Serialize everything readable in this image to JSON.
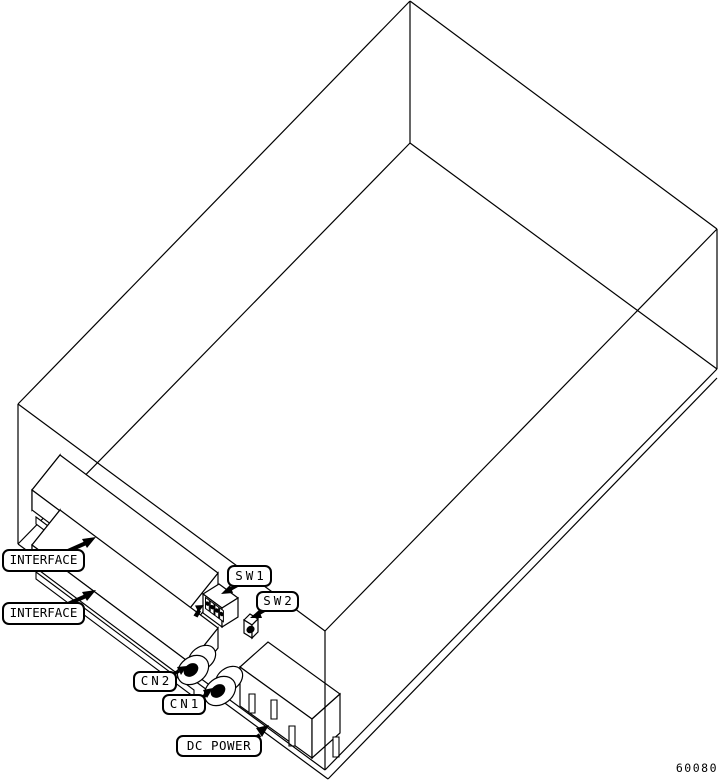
{
  "figure": {
    "drawing_number": "60080",
    "description": "Isometric outline drawing of drive enclosure showing rear connectors"
  },
  "colors": {
    "line": "#000000",
    "background": "#ffffff"
  },
  "labels": {
    "interface1": {
      "text": "INTERFACE",
      "x": 2,
      "y": 549,
      "w": 83,
      "h": 23
    },
    "interface2": {
      "text": "INTERFACE",
      "x": 2,
      "y": 602,
      "w": 83,
      "h": 23
    },
    "sw1": {
      "text": "SW1",
      "x": 227,
      "y": 565,
      "w": 45,
      "h": 22
    },
    "sw2": {
      "text": "SW2",
      "x": 256,
      "y": 591,
      "w": 43,
      "h": 21
    },
    "cn2": {
      "text": "CN2",
      "x": 133,
      "y": 671,
      "w": 44,
      "h": 21
    },
    "cn1": {
      "text": "CN1",
      "x": 162,
      "y": 694,
      "w": 44,
      "h": 21
    },
    "dc_power": {
      "text": "DC POWER",
      "x": 176,
      "y": 735,
      "w": 86,
      "h": 22
    },
    "drawing_number": {
      "text": "60080",
      "x": 672,
      "y": 760,
      "w": 46,
      "h": 16
    }
  },
  "drawing": {
    "width": 718,
    "height": 783,
    "elements": [
      {
        "n": "enclosure-top-back-left-edge",
        "t": "line",
        "p": [
          410,
          1,
          18,
          404
        ],
        "w": 1.2
      },
      {
        "n": "enclosure-top-back-right-edge",
        "t": "line",
        "p": [
          410,
          1,
          717,
          229
        ],
        "w": 1.2
      },
      {
        "n": "enclosure-back-vertical-edge",
        "t": "line",
        "p": [
          410,
          1,
          410,
          143
        ],
        "w": 1.2
      },
      {
        "n": "enclosure-bottom-back-left-edge",
        "t": "line",
        "p": [
          410,
          143,
          18,
          544
        ],
        "w": 1.2
      },
      {
        "n": "enclosure-bottom-back-right-edge",
        "t": "line",
        "p": [
          410,
          143,
          717,
          369
        ],
        "w": 1.2
      },
      {
        "n": "enclosure-left-vertical-edge",
        "t": "line",
        "p": [
          18,
          404,
          18,
          544
        ],
        "w": 1.2
      },
      {
        "n": "enclosure-top-front-left-edge",
        "t": "line",
        "p": [
          18,
          404,
          325,
          631
        ],
        "w": 1.2
      },
      {
        "n": "enclosure-top-front-right-edge",
        "t": "line",
        "p": [
          717,
          229,
          325,
          631
        ],
        "w": 1.2
      },
      {
        "n": "enclosure-right-vertical-edge",
        "t": "line",
        "p": [
          717,
          229,
          717,
          369
        ],
        "w": 1.2
      },
      {
        "n": "dc-power-connector-top-face",
        "t": "poly",
        "p": [
          240,
          667,
          268,
          642,
          340,
          694,
          312,
          719
        ],
        "f": "#fff",
        "w": 1.2
      },
      {
        "n": "dc-power-connector-front-face",
        "t": "poly",
        "p": [
          240,
          667,
          312,
          719,
          312,
          758,
          240,
          706
        ],
        "f": "#fff",
        "w": 1.2
      },
      {
        "n": "dc-power-connector-right-face",
        "t": "poly",
        "p": [
          312,
          719,
          340,
          694,
          340,
          733,
          312,
          758
        ],
        "f": "#fff",
        "w": 1.2
      },
      {
        "n": "dc-power-pin-slot-1",
        "t": "poly",
        "p": [
          249,
          694,
          255,
          694,
          255,
          713,
          249,
          713
        ],
        "f": "#fff",
        "w": 1.1
      },
      {
        "n": "dc-power-pin-slot-2",
        "t": "poly",
        "p": [
          271,
          700,
          277,
          700,
          277,
          719,
          271,
          719
        ],
        "f": "#fff",
        "w": 1.1
      },
      {
        "n": "dc-power-pin-slot-3",
        "t": "poly",
        "p": [
          289,
          726,
          295,
          726,
          295,
          746,
          289,
          746
        ],
        "f": "#fff",
        "w": 1.1
      },
      {
        "n": "dc-power-pin-slot-4",
        "t": "poly",
        "p": [
          333,
          737,
          339,
          737,
          339,
          757,
          333,
          757
        ],
        "f": "#fff",
        "w": 1.1
      },
      {
        "n": "enclosure-bottom-front-left-edge",
        "t": "line",
        "p": [
          18,
          544,
          325,
          770
        ],
        "w": 1.2
      },
      {
        "n": "base-plate-left-edge",
        "t": "line",
        "p": [
          21,
          553,
          328,
          779
        ],
        "w": 1.2
      },
      {
        "n": "enclosure-front-vertical-edge",
        "t": "line",
        "p": [
          325,
          631,
          325,
          770
        ],
        "w": 1.2
      },
      {
        "n": "enclosure-bottom-front-right-edge",
        "t": "line",
        "p": [
          717,
          369,
          325,
          770
        ],
        "w": 1.2
      },
      {
        "n": "base-plate-right-edge",
        "t": "line",
        "p": [
          717,
          378,
          328,
          779
        ],
        "w": 1.2
      },
      {
        "n": "interface-connector1-left-end",
        "t": "poly",
        "p": [
          60,
          455,
          32,
          490,
          32,
          510,
          60,
          475
        ],
        "f": "#fff",
        "w": 1.2
      },
      {
        "n": "interface-connector1-right-end",
        "t": "poly",
        "p": [
          218,
          573,
          190,
          608,
          190,
          628,
          218,
          593
        ],
        "f": "#fff",
        "w": 1.2
      },
      {
        "n": "interface-connector1-top-face",
        "t": "poly",
        "p": [
          60,
          455,
          218,
          573,
          190,
          608,
          32,
          490
        ],
        "f": "#fff",
        "w": 1.2
      },
      {
        "n": "interface-connector1-front-face",
        "t": "poly",
        "p": [
          32,
          490,
          190,
          608,
          190,
          628,
          32,
          510
        ],
        "f": "#fff",
        "w": 1.2
      },
      {
        "n": "interface-card-edge-1",
        "t": "poly",
        "p": [
          36,
          517,
          194,
          635,
          194,
          642,
          36,
          524
        ],
        "f": "#fff",
        "w": 1.1
      },
      {
        "n": "interface-connector2-left-end",
        "t": "poly",
        "p": [
          60,
          510,
          32,
          545,
          32,
          565,
          60,
          530
        ],
        "f": "#fff",
        "w": 1.2
      },
      {
        "n": "interface-connector2-right-end",
        "t": "poly",
        "p": [
          218,
          628,
          190,
          663,
          190,
          683,
          218,
          648
        ],
        "f": "#fff",
        "w": 1.2
      },
      {
        "n": "interface-connector2-top-face",
        "t": "poly",
        "p": [
          60,
          510,
          218,
          628,
          190,
          663,
          32,
          545
        ],
        "f": "#fff",
        "w": 1.2
      },
      {
        "n": "interface-connector2-front-face",
        "t": "poly",
        "p": [
          32,
          545,
          190,
          663,
          190,
          683,
          32,
          565
        ],
        "f": "#fff",
        "w": 1.2
      },
      {
        "n": "interface-card-edge-2",
        "t": "poly",
        "p": [
          36,
          572,
          194,
          690,
          194,
          697,
          36,
          579
        ],
        "f": "#fff",
        "w": 1.1
      },
      {
        "n": "cn2-connector-barrel",
        "t": "ell",
        "c": [
          202,
          658
        ],
        "r": [
          15,
          11
        ],
        "rot": -38,
        "f": "#fff",
        "w": 1.2
      },
      {
        "n": "cn2-connector-flange",
        "t": "ell",
        "c": [
          193,
          670
        ],
        "r": [
          17,
          13
        ],
        "rot": -38,
        "f": "#fff",
        "w": 1.2
      },
      {
        "n": "cn2-connector-hole",
        "t": "ell",
        "c": [
          191,
          670
        ],
        "r": [
          8,
          6
        ],
        "rot": -38,
        "f": "#000",
        "w": 0
      },
      {
        "n": "cn1-connector-barrel",
        "t": "ell",
        "c": [
          229,
          679
        ],
        "r": [
          15,
          11
        ],
        "rot": -38,
        "f": "#fff",
        "w": 1.2
      },
      {
        "n": "cn1-connector-flange",
        "t": "ell",
        "c": [
          220,
          691
        ],
        "r": [
          17,
          13
        ],
        "rot": -38,
        "f": "#fff",
        "w": 1.2
      },
      {
        "n": "cn1-connector-hole",
        "t": "ell",
        "c": [
          218,
          691
        ],
        "r": [
          8,
          6
        ],
        "rot": -38,
        "f": "#000",
        "w": 0
      },
      {
        "n": "sw1-dip-switch-top-face",
        "t": "poly",
        "p": [
          203,
          594,
          219,
          584,
          238,
          598,
          222,
          608
        ],
        "f": "#fff",
        "w": 1.2
      },
      {
        "n": "sw1-dip-switch-front-face",
        "t": "poly",
        "p": [
          203,
          594,
          222,
          608,
          222,
          627,
          203,
          613
        ],
        "f": "#fff",
        "w": 1.2
      },
      {
        "n": "sw1-dip-switch-right-face",
        "t": "poly",
        "p": [
          222,
          608,
          238,
          598,
          238,
          617,
          222,
          627
        ],
        "f": "#fff",
        "w": 1.2
      },
      {
        "n": "sw1-dip-position-1",
        "t": "poly",
        "p": [
          205.5,
          597.5,
          209.3,
          600.3,
          209.3,
          611.3,
          205.5,
          608.5
        ],
        "f": "#fff",
        "w": 1
      },
      {
        "n": "sw1-dip-position-2",
        "t": "poly",
        "p": [
          210.2,
          601,
          214,
          603.8,
          214,
          614.8,
          210.2,
          612
        ],
        "f": "#fff",
        "w": 1
      },
      {
        "n": "sw1-dip-position-3",
        "t": "poly",
        "p": [
          214.9,
          604.4,
          218.7,
          607.2,
          218.7,
          618.2,
          214.9,
          615.4
        ],
        "f": "#fff",
        "w": 1
      },
      {
        "n": "sw1-dip-position-4",
        "t": "poly",
        "p": [
          219.6,
          607.9,
          223.4,
          610.7,
          223.4,
          621.7,
          219.6,
          618.9
        ],
        "f": "#fff",
        "w": 1
      },
      {
        "n": "sw1-dip-dot-1",
        "t": "ell",
        "c": [
          207.4,
          603.6
        ],
        "r": [
          1.9,
          2.4
        ],
        "rot": -35,
        "f": "#000",
        "w": 0
      },
      {
        "n": "sw1-dip-dot-2",
        "t": "ell",
        "c": [
          212.1,
          607.1
        ],
        "r": [
          1.9,
          2.4
        ],
        "rot": -35,
        "f": "#000",
        "w": 0
      },
      {
        "n": "sw1-dip-dot-3",
        "t": "ell",
        "c": [
          216.8,
          610.5
        ],
        "r": [
          1.9,
          2.4
        ],
        "rot": -35,
        "f": "#000",
        "w": 0
      },
      {
        "n": "sw1-dip-dot-4",
        "t": "ell",
        "c": [
          221.5,
          614.0
        ],
        "r": [
          1.9,
          2.4
        ],
        "rot": -35,
        "f": "#000",
        "w": 0
      },
      {
        "n": "sw1-direction-arrow-head",
        "t": "poly",
        "p": [
          204,
          605,
          195,
          605.5,
          198.5,
          612.5
        ],
        "f": "#000",
        "w": 0
      },
      {
        "n": "sw1-direction-arrow-tail",
        "t": "poly",
        "p": [
          198,
          608.5,
          193.5,
          615.5,
          197.5,
          617.5,
          201,
          611.5
        ],
        "f": "#000",
        "w": 0
      },
      {
        "n": "sw2-switch-top-face",
        "t": "poly",
        "p": [
          244,
          620,
          250,
          614,
          258,
          619,
          252,
          625
        ],
        "f": "#fff",
        "w": 1.2
      },
      {
        "n": "sw2-switch-front-face",
        "t": "poly",
        "p": [
          244,
          620,
          252,
          625,
          252,
          638,
          244,
          633
        ],
        "f": "#fff",
        "w": 1.2
      },
      {
        "n": "sw2-switch-right-face",
        "t": "poly",
        "p": [
          252,
          625,
          258,
          619,
          258,
          632,
          252,
          638
        ],
        "f": "#fff",
        "w": 1.2
      },
      {
        "n": "sw2-switch-button",
        "t": "ell",
        "c": [
          250.5,
          629.5
        ],
        "r": [
          4.2,
          3.6
        ],
        "rot": -32,
        "f": "#000",
        "w": 0
      },
      {
        "n": "interface1-leader-line",
        "t": "line",
        "p": [
          50,
          559,
          86,
          543
        ],
        "w": 4
      },
      {
        "n": "interface1-leader-arrowhead",
        "t": "poly",
        "p": [
          96,
          537,
          82,
          539,
          87,
          548
        ],
        "f": "#000",
        "w": 0
      },
      {
        "n": "interface2-leader-line",
        "t": "line",
        "p": [
          50,
          612,
          86,
          596
        ],
        "w": 4
      },
      {
        "n": "interface2-leader-arrowhead",
        "t": "poly",
        "p": [
          96,
          590,
          82,
          592,
          87,
          601
        ],
        "f": "#000",
        "w": 0
      },
      {
        "n": "sw1-leader-line",
        "t": "line",
        "p": [
          238,
          585,
          229,
          590
        ],
        "w": 3.5
      },
      {
        "n": "sw1-leader-arrowhead",
        "t": "poly",
        "p": [
          221,
          594,
          230,
          585,
          233,
          593
        ],
        "f": "#000",
        "w": 0
      },
      {
        "n": "sw2-leader-line",
        "t": "line",
        "p": [
          265,
          610,
          258,
          614
        ],
        "w": 3.5
      },
      {
        "n": "sw2-leader-arrowhead",
        "t": "poly",
        "p": [
          250,
          618,
          259,
          610,
          262,
          618
        ],
        "f": "#000",
        "w": 0
      },
      {
        "n": "cn2-leader-line",
        "t": "line",
        "p": [
          170,
          676,
          179,
          671
        ],
        "w": 3.5
      },
      {
        "n": "cn2-leader-arrowhead",
        "t": "poly",
        "p": [
          187,
          666,
          177,
          667,
          181,
          675
        ],
        "f": "#000",
        "w": 0
      },
      {
        "n": "cn1-leader-line",
        "t": "line",
        "p": [
          199,
          699,
          206,
          695
        ],
        "w": 3.5
      },
      {
        "n": "cn1-leader-arrowhead",
        "t": "poly",
        "p": [
          213,
          688,
          203,
          690,
          207,
          698
        ],
        "f": "#000",
        "w": 0
      },
      {
        "n": "dc-power-leader-line",
        "t": "line",
        "p": [
          250,
          742,
          260,
          735
        ],
        "w": 4
      },
      {
        "n": "dc-power-leader-arrowhead",
        "t": "poly",
        "p": [
          269,
          725,
          256,
          728,
          262,
          737
        ],
        "f": "#000",
        "w": 0
      }
    ]
  }
}
